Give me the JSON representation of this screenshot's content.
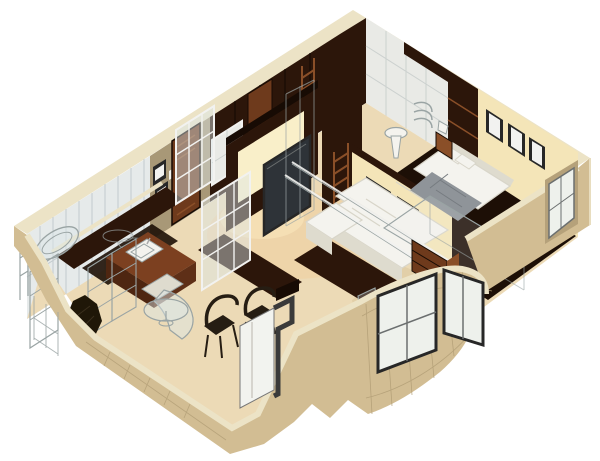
{
  "meta": {
    "title": "3D isometric cutaway render of a one-bedroom apartment floor plan",
    "style": "architectural 3D visualization, walls cut at top, viewed from above",
    "background": "#ffffff"
  },
  "colors": {
    "bg": "#ffffff",
    "band": "#ece3c6",
    "wallFace": "#d2bd93",
    "backWall": "#e4d2a8",
    "oliveWall": "#a89877",
    "tileWall": "#e6eaea",
    "tileLine": "#c3cbce",
    "panelWall": "#e9eae6",
    "panelLine": "#ccd1cf",
    "creamLit": "#f4e5b8",
    "litGlow": "#f9efc9",
    "wenge": "#2c160a",
    "wengeDark": "#170b04",
    "woodDoor": "#6e3a1c",
    "woodMid": "#8a4f28",
    "counterTop": "#7c4020",
    "counterFront": "#4e2611",
    "counterSide": "#5e2f17",
    "floorLight": "#ecdab6",
    "floorWarm": "#f0cf9f",
    "floorBay": "#e2cfa8",
    "floorDark": "#1d0f06",
    "white": "#f4f3ee",
    "whiteShade": "#ded bce",
    "quilt": "#8f9499",
    "screen": "#2e3338",
    "frameDark": "#272727",
    "frameWhite": "#f2f2f0",
    "glass": "#dce6e8",
    "glassPane": "#eef1ec",
    "nicheShadow": "#b5a17a",
    "doorWhite": "#f2f3ef",
    "ghost": "#9aa4a4",
    "chairDark": "#261d13",
    "gridLine": "#b29d76"
  },
  "scene": {
    "projection": "isometric cutaway",
    "rooms": [
      {
        "name": "bathroom",
        "position": "top-left",
        "walls": "light gray tile panels",
        "features": [
          "wireframe bathtub",
          "shower rack",
          "dark tile floor",
          "wireframe storage shelving"
        ]
      },
      {
        "name": "entry-hall",
        "position": "left-center",
        "features": [
          "two framed pictures",
          "dark wooden entry door",
          "light switch"
        ]
      },
      {
        "name": "hallway-closets",
        "position": "top-center",
        "features": [
          "dark wenge wardrobe wall",
          "wooden ladder",
          "framed mirror",
          "second ladder closet",
          "pedestal washbasin",
          "wireframe towel radiator",
          "wireframe shower column"
        ]
      },
      {
        "name": "walk-in-closet",
        "position": "top",
        "features": [
          "white panel wardrobe doors",
          "dark trim strip"
        ]
      },
      {
        "name": "bedroom",
        "position": "right",
        "floor": "dark walnut",
        "furniture": [
          "white double bed",
          "two pillows",
          "gray quilt",
          "nightstand with lamp",
          "three picture frames on wall",
          "wireframe ghost wardrobe"
        ]
      },
      {
        "name": "living-room",
        "position": "center",
        "furniture": [
          "white corner sofa",
          "flat TV on dark media wall",
          "backlit niche",
          "two shoji glass partitions",
          "two framed pictures",
          "glass balustrade rails"
        ]
      },
      {
        "name": "kitchen",
        "position": "bottom-left",
        "furniture": [
          "L-shaped mahogany counter",
          "white sink",
          "white cooker",
          "curved glass bar",
          "round glass table",
          "two dark bentwood chairs",
          "dark potted plant",
          "wireframe upper cabinets",
          "wireframe ceiling rack"
        ]
      },
      {
        "name": "dining-nook",
        "position": "bottom-center",
        "features": [
          "white french-door niche",
          "stepped dark window frame",
          "wireframe chair"
        ]
      },
      {
        "name": "bay-balcony",
        "position": "bottom-right",
        "features": [
          "curved glazed bay wall",
          "two large windows",
          "mahogany shelf unit",
          "dark wall tablet"
        ]
      }
    ],
    "exterior": {
      "walls": "sand-beige masonry cut flat at top",
      "cut_band": "pale cream strip along every wall top",
      "texture": "thin construction-grid lines on outer faces",
      "windows": [
        "recessed window in right wall",
        "two bay windows",
        "dining french window",
        "kitchen side wireframe window"
      ]
    }
  }
}
